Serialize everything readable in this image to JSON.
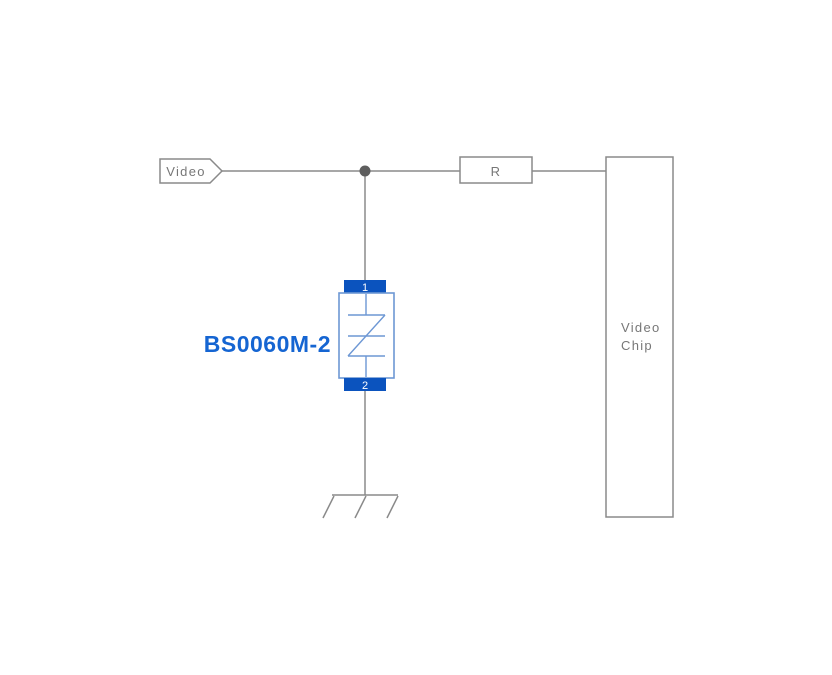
{
  "diagram": {
    "net_label": "Video",
    "resistor_label": "R",
    "chip_label": {
      "line1": "Video",
      "line2": "Chip"
    },
    "component": {
      "name": "BS0060M-2",
      "pin1": "1",
      "pin2": "2"
    }
  },
  "colors": {
    "background": "#ffffff",
    "wire": "#8a8a8a",
    "label_text": "#777777",
    "junction": "#5e5e5e",
    "pin_fill": "#0b53be",
    "pin_text": "#ffffff",
    "symbol_stroke": "#6d97d4",
    "component_name_text": "#1565d2"
  }
}
